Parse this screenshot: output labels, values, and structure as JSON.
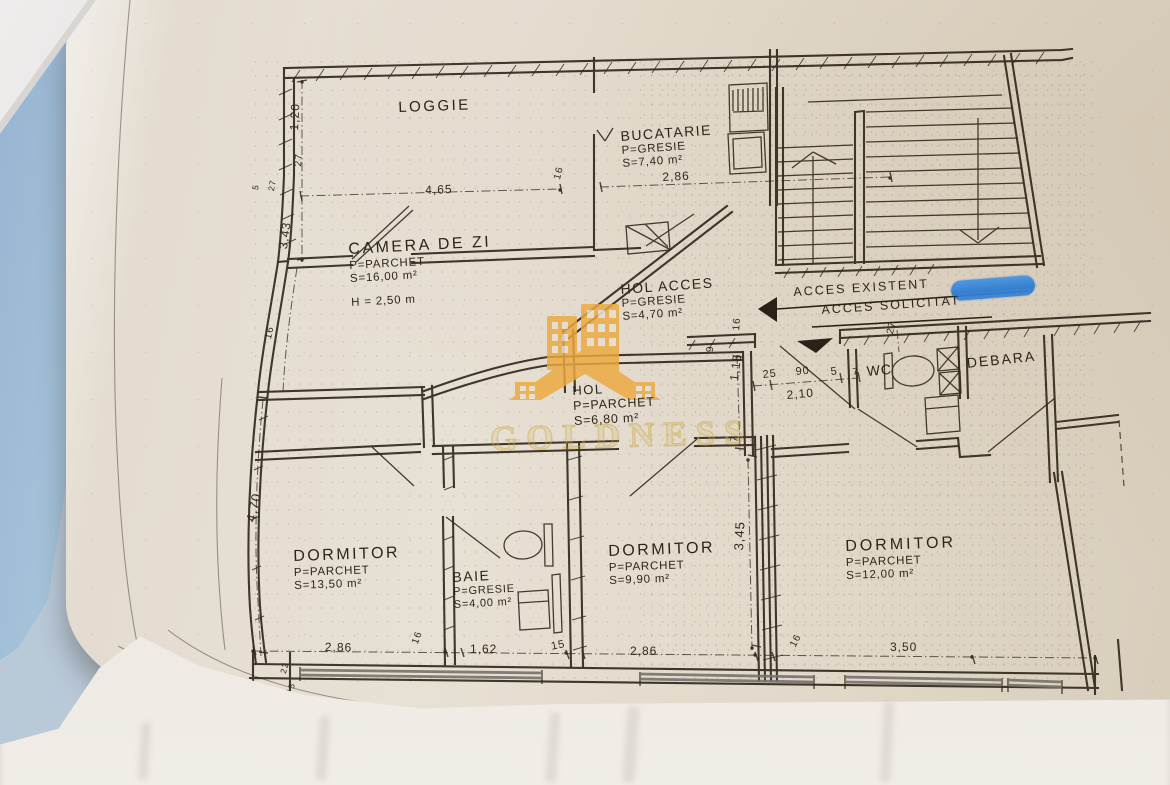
{
  "watermark": {
    "brand": "GOLDNESS",
    "logo_color": "#E8A33D",
    "text_color": "#D4AF37"
  },
  "highlight_color": "#2E7BD0",
  "plan": {
    "rooms": [
      {
        "name": "LOGGIE"
      },
      {
        "name": "BUCATARIE",
        "finish": "P=GRESIE",
        "area": "S=7,40 m²"
      },
      {
        "name": "CAMERA DE ZI",
        "finish": "P=PARCHET",
        "area": "S=16,00 m²",
        "height": "H = 2,50 m"
      },
      {
        "name": "HOL ACCES",
        "finish": "P=GRESIE",
        "area": "S=4,70 m²"
      },
      {
        "name": "HOL",
        "finish": "P=PARCHET",
        "area": "S=6,80 m²"
      },
      {
        "name": "WC"
      },
      {
        "name": "DEBARA"
      },
      {
        "name": "DORMITOR",
        "finish": "P=PARCHET",
        "area": "S=13,50 m²"
      },
      {
        "name": "BAIE",
        "finish": "P=GRESIE",
        "area": "S=4,00 m²"
      },
      {
        "name": "DORMITOR",
        "finish": "P=PARCHET",
        "area": "S=9,90 m²"
      },
      {
        "name": "DORMITOR",
        "finish": "P=PARCHET",
        "area": "S=12,00 m²"
      }
    ],
    "annotations": {
      "existent": "ACCES EXISTENT",
      "solicitat": "ACCES SOLICITAT"
    },
    "dims": [
      "1,20",
      "27",
      "5",
      "27",
      "4,65",
      "16",
      "2,86",
      "3,43",
      "16",
      "16",
      "9",
      "25",
      "90",
      "5",
      "2,10",
      "1,15",
      "7",
      "27",
      "7",
      "4,70",
      "3,45",
      "2,86",
      "16",
      "1,62",
      "15",
      "2,86",
      "16",
      "3,50",
      "22",
      "5"
    ]
  }
}
